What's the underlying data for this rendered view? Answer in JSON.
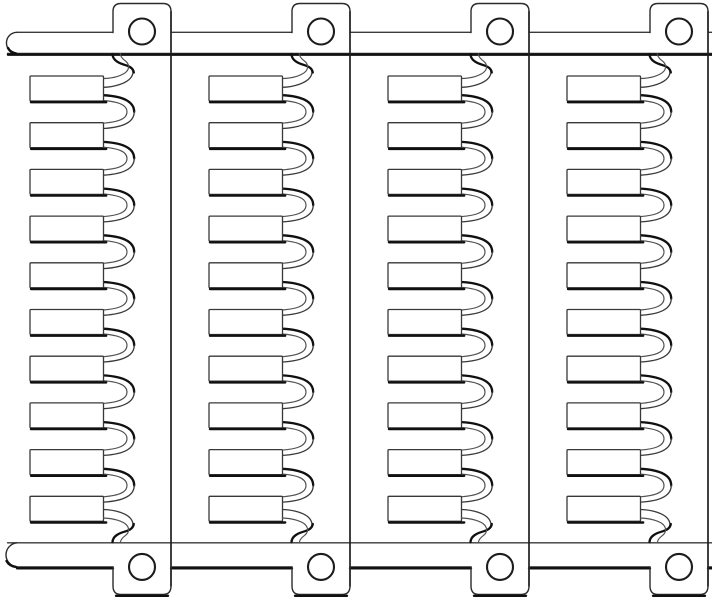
{
  "figure": {
    "canvas": {
      "width": 712,
      "height": 600,
      "background": "#ffffff"
    },
    "colors": {
      "main": "#2b2b2b",
      "secondary": "#3a3a3a",
      "light": "#515151",
      "shadow": "#101010",
      "spine": "#1f1f1f",
      "hole": "#1c1c1c",
      "tab": "#383838",
      "fill": "#ffffff"
    },
    "stroke_widths": {
      "main": 1.4,
      "secondary": 1.3,
      "light": 1.15,
      "shadow": 2.4,
      "accent": 2.3,
      "spine": 1.7,
      "hole": 2.1
    },
    "units": {
      "count": 4,
      "offsets_x": [
        0,
        179,
        358,
        537
      ]
    },
    "bars": {
      "top": {
        "y1": 32.3,
        "y2": 53.4,
        "left_cap_x": 17,
        "cap_radius": 10.4
      },
      "bottom": {
        "y1": 542.8,
        "y2": 566.9,
        "left_cap_x": 17,
        "cap_radius": 12.1
      }
    },
    "rail": {
      "mount_tab_x1": 113,
      "mount_tab_x2": 171,
      "top_tab_top_y": 3.5,
      "bottom_tab_bottom_y": 594.5,
      "corner_radius": 8,
      "spine_top_y": 11.5,
      "spine_bottom_y": 586
    },
    "holes": {
      "radius": 13,
      "top_center": {
        "x": 142,
        "y": 31.5
      },
      "bottom_center": {
        "x": 142,
        "y": 566.9
      }
    },
    "tabs": {
      "count_per_unit": 10,
      "x": 30,
      "width": 73.5,
      "height": 25,
      "first_top_y": 76,
      "pitch_y": 46.7
    },
    "serpentine": {
      "attach_x": 103.5,
      "outer_bulge_x": 134.2,
      "inner_bulge_x": 127
    }
  }
}
